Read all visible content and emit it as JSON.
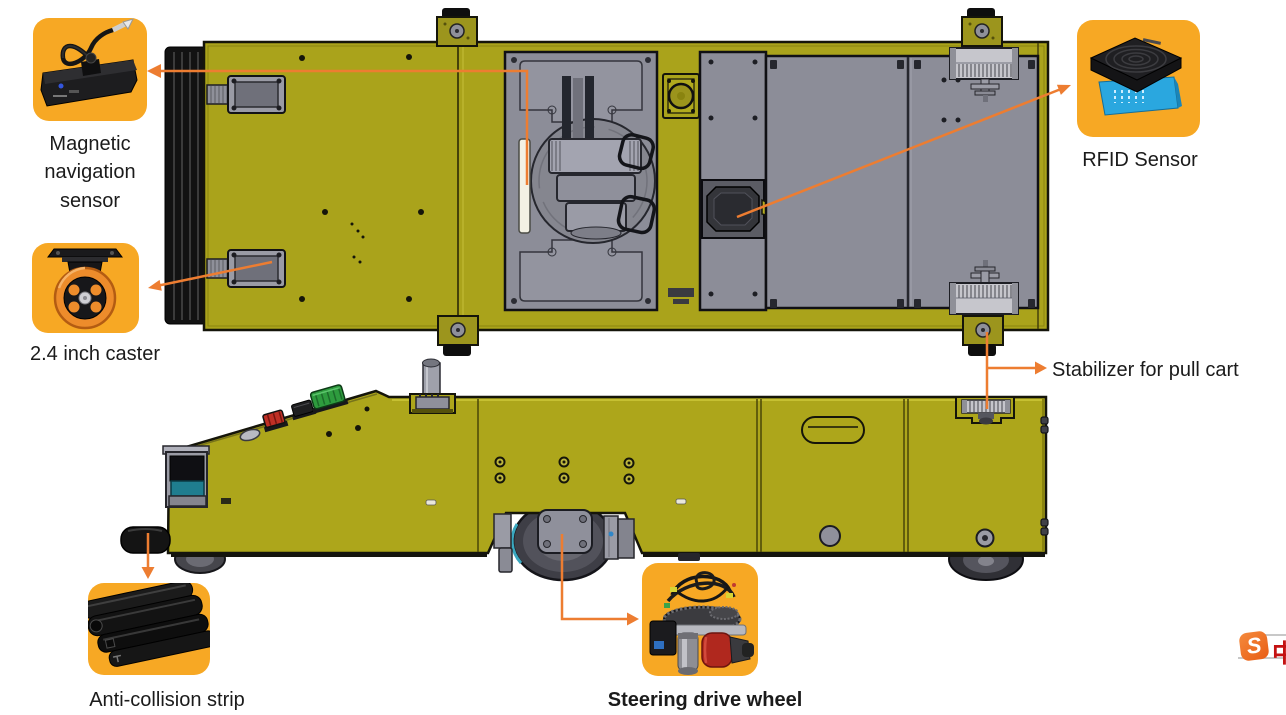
{
  "callouts": {
    "magnetic": {
      "label": "Magnetic navigation sensor"
    },
    "rfid": {
      "label": "RFID Sensor"
    },
    "caster": {
      "label": "2.4 inch caster"
    },
    "stabilizer": {
      "label": "Stabilizer for pull cart"
    },
    "anticollision": {
      "label": "Anti-collision strip"
    },
    "steering": {
      "label": "Steering drive wheel"
    }
  },
  "watermark": {
    "letter": "S",
    "cjk": "中"
  },
  "colors": {
    "accent_box": "#F7A824",
    "callout_line": "#ED7D31",
    "agv_body_yellow": "#ABA41B",
    "plate_gray": "#8C8D98",
    "label_text": "#1B1B1B"
  }
}
